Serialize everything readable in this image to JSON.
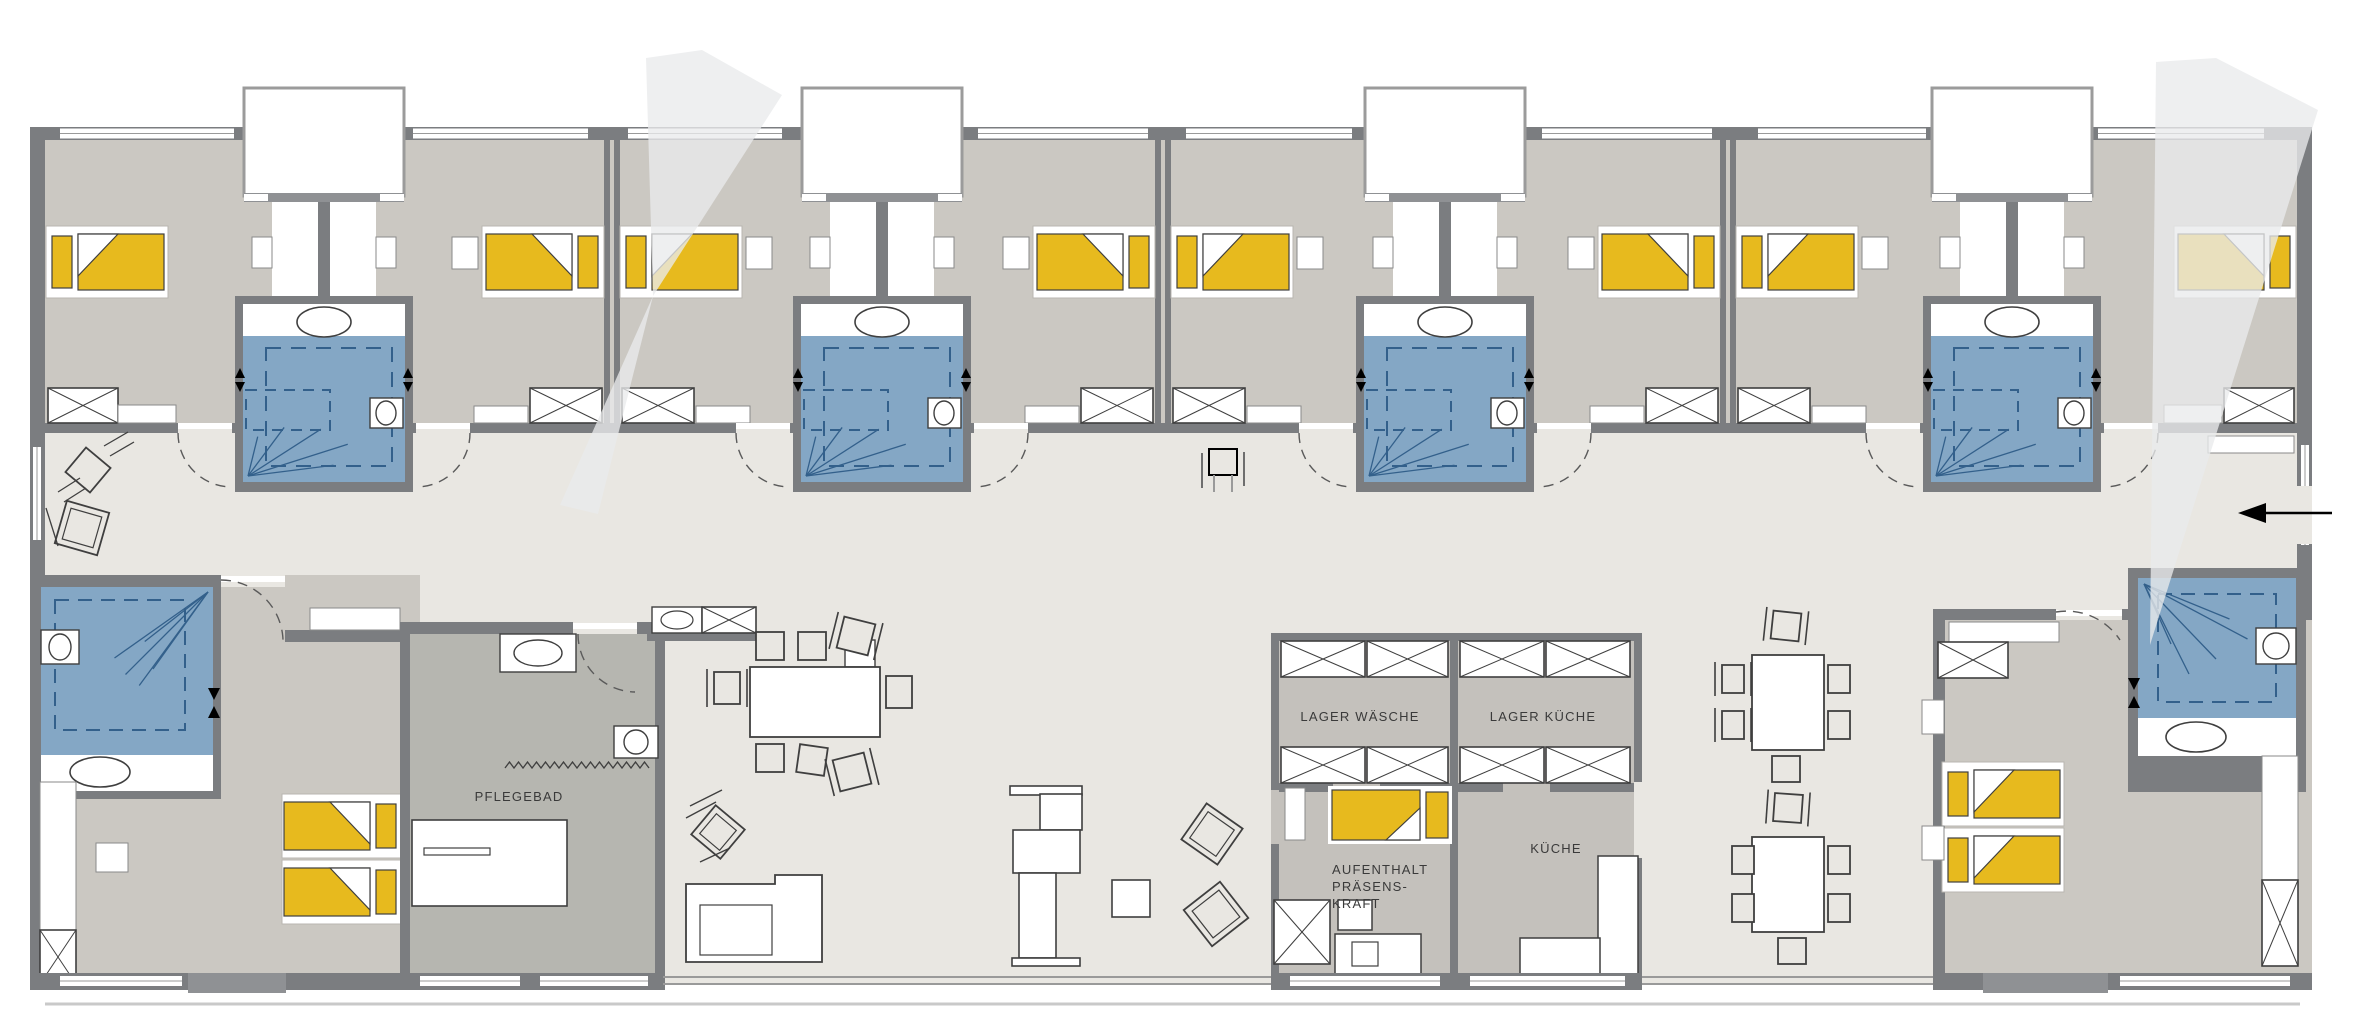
{
  "plan": {
    "type": "floor-plan",
    "bedroom_modules": 4,
    "resident_rooms_top": 8,
    "suites_bottom": 2,
    "module_centers": [
      324,
      882,
      1445,
      2012
    ],
    "partitions": [
      612,
      1163,
      1728
    ]
  },
  "labels": {
    "pflegebad": "PFLEGEBAD",
    "lager_waesche": "LAGER WÄSCHE",
    "lager_kueche": "LAGER KÜCHE",
    "kueche": "KÜCHE",
    "aufenthalt_lines": [
      "AUFENTHALT",
      "PRÄSENS-",
      "KRAFT"
    ]
  },
  "icons": {
    "entrance_arrow": "left-arrow",
    "door_swing": "dashed-quarter-arc",
    "wardrobe": "crossed-box",
    "shower_spray": "fan-lines"
  },
  "colors": {
    "wall": "#7b7d80",
    "wallLight": "#8f9194",
    "roomFloor": "#cbc8c2",
    "corridorFloor": "#e9e7e2",
    "serviceFloor": "#c4c1bc",
    "bathRoomFloor": "#b6b6b0",
    "bathBlue": "#84a7c5",
    "bathBlueDark": "#33608b",
    "bedYellow": "#e7ba1e",
    "white": "#ffffff",
    "furnitureLine": "#3f3f3f",
    "cone": "#e9eaec"
  }
}
